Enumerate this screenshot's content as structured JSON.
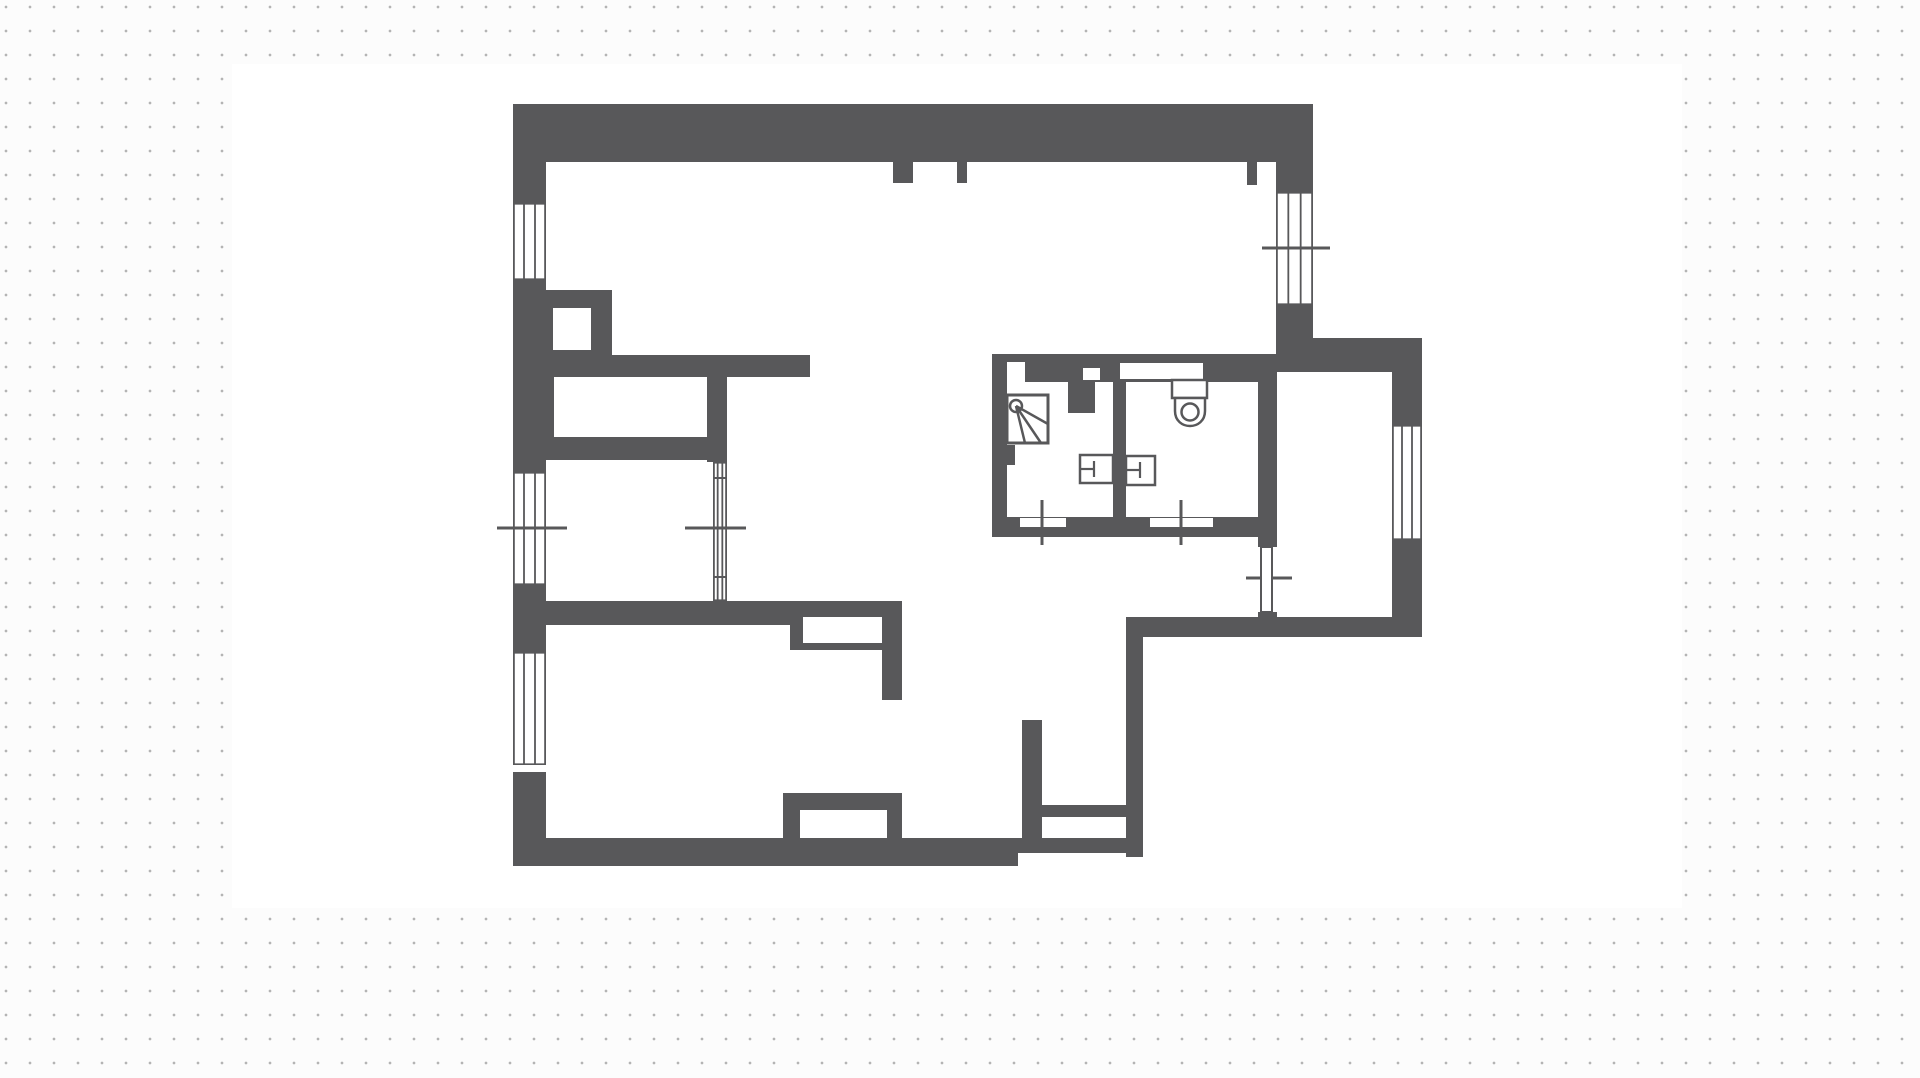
{
  "page": {
    "width": 1920,
    "height": 1078,
    "background_color": "#fcfcfc",
    "dot_color": "#b4b4b4",
    "dot_spacing": 24,
    "canvas_color": "#ffffff",
    "wall_color": "#58585a"
  },
  "floor_plan": {
    "canvas": {
      "x": 232,
      "y": 64,
      "w": 1450,
      "h": 844
    },
    "walls": [
      [
        513,
        104,
        800,
        58
      ],
      [
        513,
        162,
        33,
        41
      ],
      [
        513,
        280,
        33,
        192
      ],
      [
        513,
        585,
        33,
        67
      ],
      [
        513,
        772,
        33,
        94
      ],
      [
        1247,
        162,
        10,
        23
      ],
      [
        1276,
        162,
        37,
        30
      ],
      [
        1276,
        305,
        37,
        33
      ],
      [
        893,
        162,
        20,
        21
      ],
      [
        957,
        162,
        10,
        21
      ],
      [
        1276,
        338,
        146,
        34
      ],
      [
        1392,
        372,
        30,
        53
      ],
      [
        1392,
        540,
        30,
        97
      ],
      [
        1126,
        617,
        296,
        20
      ],
      [
        1126,
        635,
        17,
        222
      ],
      [
        1018,
        838,
        125,
        15
      ],
      [
        513,
        838,
        505,
        28
      ],
      [
        546,
        290,
        66,
        67
      ],
      [
        546,
        355,
        264,
        22
      ],
      [
        546,
        377,
        8,
        60
      ],
      [
        707,
        377,
        20,
        85
      ],
      [
        513,
        437,
        204,
        23
      ],
      [
        513,
        601,
        389,
        16
      ],
      [
        513,
        617,
        277,
        8
      ],
      [
        790,
        617,
        13,
        33
      ],
      [
        803,
        643,
        79,
        7
      ],
      [
        882,
        617,
        20,
        83
      ],
      [
        783,
        793,
        17,
        45
      ],
      [
        800,
        793,
        87,
        17
      ],
      [
        887,
        793,
        15,
        45
      ],
      [
        1022,
        720,
        20,
        133
      ],
      [
        1042,
        805,
        86,
        12
      ],
      [
        992,
        354,
        285,
        28
      ],
      [
        992,
        382,
        15,
        135
      ],
      [
        1007,
        445,
        8,
        20
      ],
      [
        1068,
        382,
        27,
        31
      ],
      [
        1113,
        379,
        13,
        138
      ],
      [
        992,
        517,
        285,
        20
      ],
      [
        1258,
        382,
        19,
        155
      ],
      [
        1258,
        537,
        19,
        10
      ],
      [
        1258,
        612,
        19,
        25
      ]
    ],
    "cutouts": [
      {
        "name": "shaft-niche",
        "r": [
          553,
          308,
          38,
          42
        ]
      },
      {
        "name": "closet-slot",
        "r": [
          554,
          377,
          153,
          60
        ]
      },
      {
        "name": "pocket-slot",
        "r": [
          803,
          617,
          79,
          26
        ]
      },
      {
        "name": "radiator-niche",
        "r": [
          800,
          810,
          87,
          28
        ]
      },
      {
        "name": "wardrobe-niche",
        "r": [
          1042,
          817,
          84,
          21
        ]
      },
      {
        "name": "bath-corner-notch",
        "r": [
          1007,
          362,
          18,
          20
        ]
      },
      {
        "name": "bath-wall-square",
        "r": [
          1083,
          368,
          17,
          12
        ]
      },
      {
        "name": "wc-cistern-recess",
        "r": [
          1120,
          363,
          83,
          16
        ]
      },
      {
        "name": "shower-door-leaf",
        "r": [
          1020,
          518,
          46,
          9
        ]
      },
      {
        "name": "wc-door-leaf",
        "r": [
          1150,
          518,
          63,
          9
        ]
      }
    ],
    "windows": [
      {
        "name": "window-left-top",
        "x": 513,
        "y": 203,
        "w": 33,
        "h": 77
      },
      {
        "name": "window-left-middle",
        "x": 513,
        "y": 472,
        "w": 33,
        "h": 113
      },
      {
        "name": "window-left-bottom",
        "x": 513,
        "y": 652,
        "w": 33,
        "h": 113
      },
      {
        "name": "window-top-right",
        "x": 1276,
        "y": 192,
        "w": 37,
        "h": 113
      },
      {
        "name": "window-right",
        "x": 1392,
        "y": 425,
        "w": 30,
        "h": 115
      },
      {
        "name": "glazed-partition",
        "x": 713,
        "y": 462,
        "w": 14,
        "h": 139
      }
    ],
    "marker_lines": [
      {
        "name": "sill-line-left-middle",
        "x1": 497,
        "y1": 528,
        "x2": 567,
        "y2": 528,
        "w": 3
      },
      {
        "name": "sill-line-partition",
        "x1": 685,
        "y1": 528,
        "x2": 746,
        "y2": 528,
        "w": 3
      },
      {
        "name": "sill-line-top-right",
        "x1": 1262,
        "y1": 248,
        "x2": 1330,
        "y2": 248,
        "w": 3
      },
      {
        "name": "door-axis-shower",
        "x1": 1042,
        "y1": 500,
        "x2": 1042,
        "y2": 545,
        "w": 3
      },
      {
        "name": "door-axis-wc",
        "x1": 1181,
        "y1": 500,
        "x2": 1181,
        "y2": 545,
        "w": 3
      },
      {
        "name": "door-axis-right-room",
        "x1": 1246,
        "y1": 578,
        "x2": 1292,
        "y2": 578,
        "w": 3
      },
      {
        "name": "partition-bar",
        "x1": 713,
        "y1": 478,
        "x2": 727,
        "y2": 478,
        "w": 2
      },
      {
        "name": "partition-bar",
        "x1": 713,
        "y1": 577,
        "x2": 727,
        "y2": 577,
        "w": 2
      }
    ],
    "door_leaves": [
      {
        "name": "right-room-door-leaf",
        "r": [
          1261,
          547,
          11,
          65
        ]
      }
    ],
    "fixtures": {
      "shower": {
        "square": [
          1007,
          395,
          41,
          48
        ],
        "head_circle": {
          "cx": 1016,
          "cy": 406,
          "r": 6
        },
        "spray_lines": [
          [
            1016,
            406,
            1048,
            424
          ],
          [
            1016,
            406,
            1041,
            443
          ],
          [
            1016,
            406,
            1025,
            443
          ]
        ]
      },
      "toilet": {
        "cistern": [
          1172,
          380,
          35,
          18
        ],
        "bowl_path": "M1175,398 L1175,411 C1175,431 1205,431 1205,411 L1205,398 Z",
        "seat_circle": {
          "cx": 1190,
          "cy": 412,
          "r": 8.5
        }
      },
      "sinks": [
        {
          "rect": [
            1080,
            455,
            33,
            28
          ],
          "h_line": [
            1080,
            469,
            1094,
            469
          ],
          "v_line": [
            1094,
            461,
            1094,
            477
          ]
        },
        {
          "rect": [
            1126,
            456,
            29,
            29
          ],
          "h_line": [
            1126,
            470,
            1140,
            470
          ],
          "v_line": [
            1140,
            462,
            1140,
            478
          ]
        }
      ]
    }
  }
}
